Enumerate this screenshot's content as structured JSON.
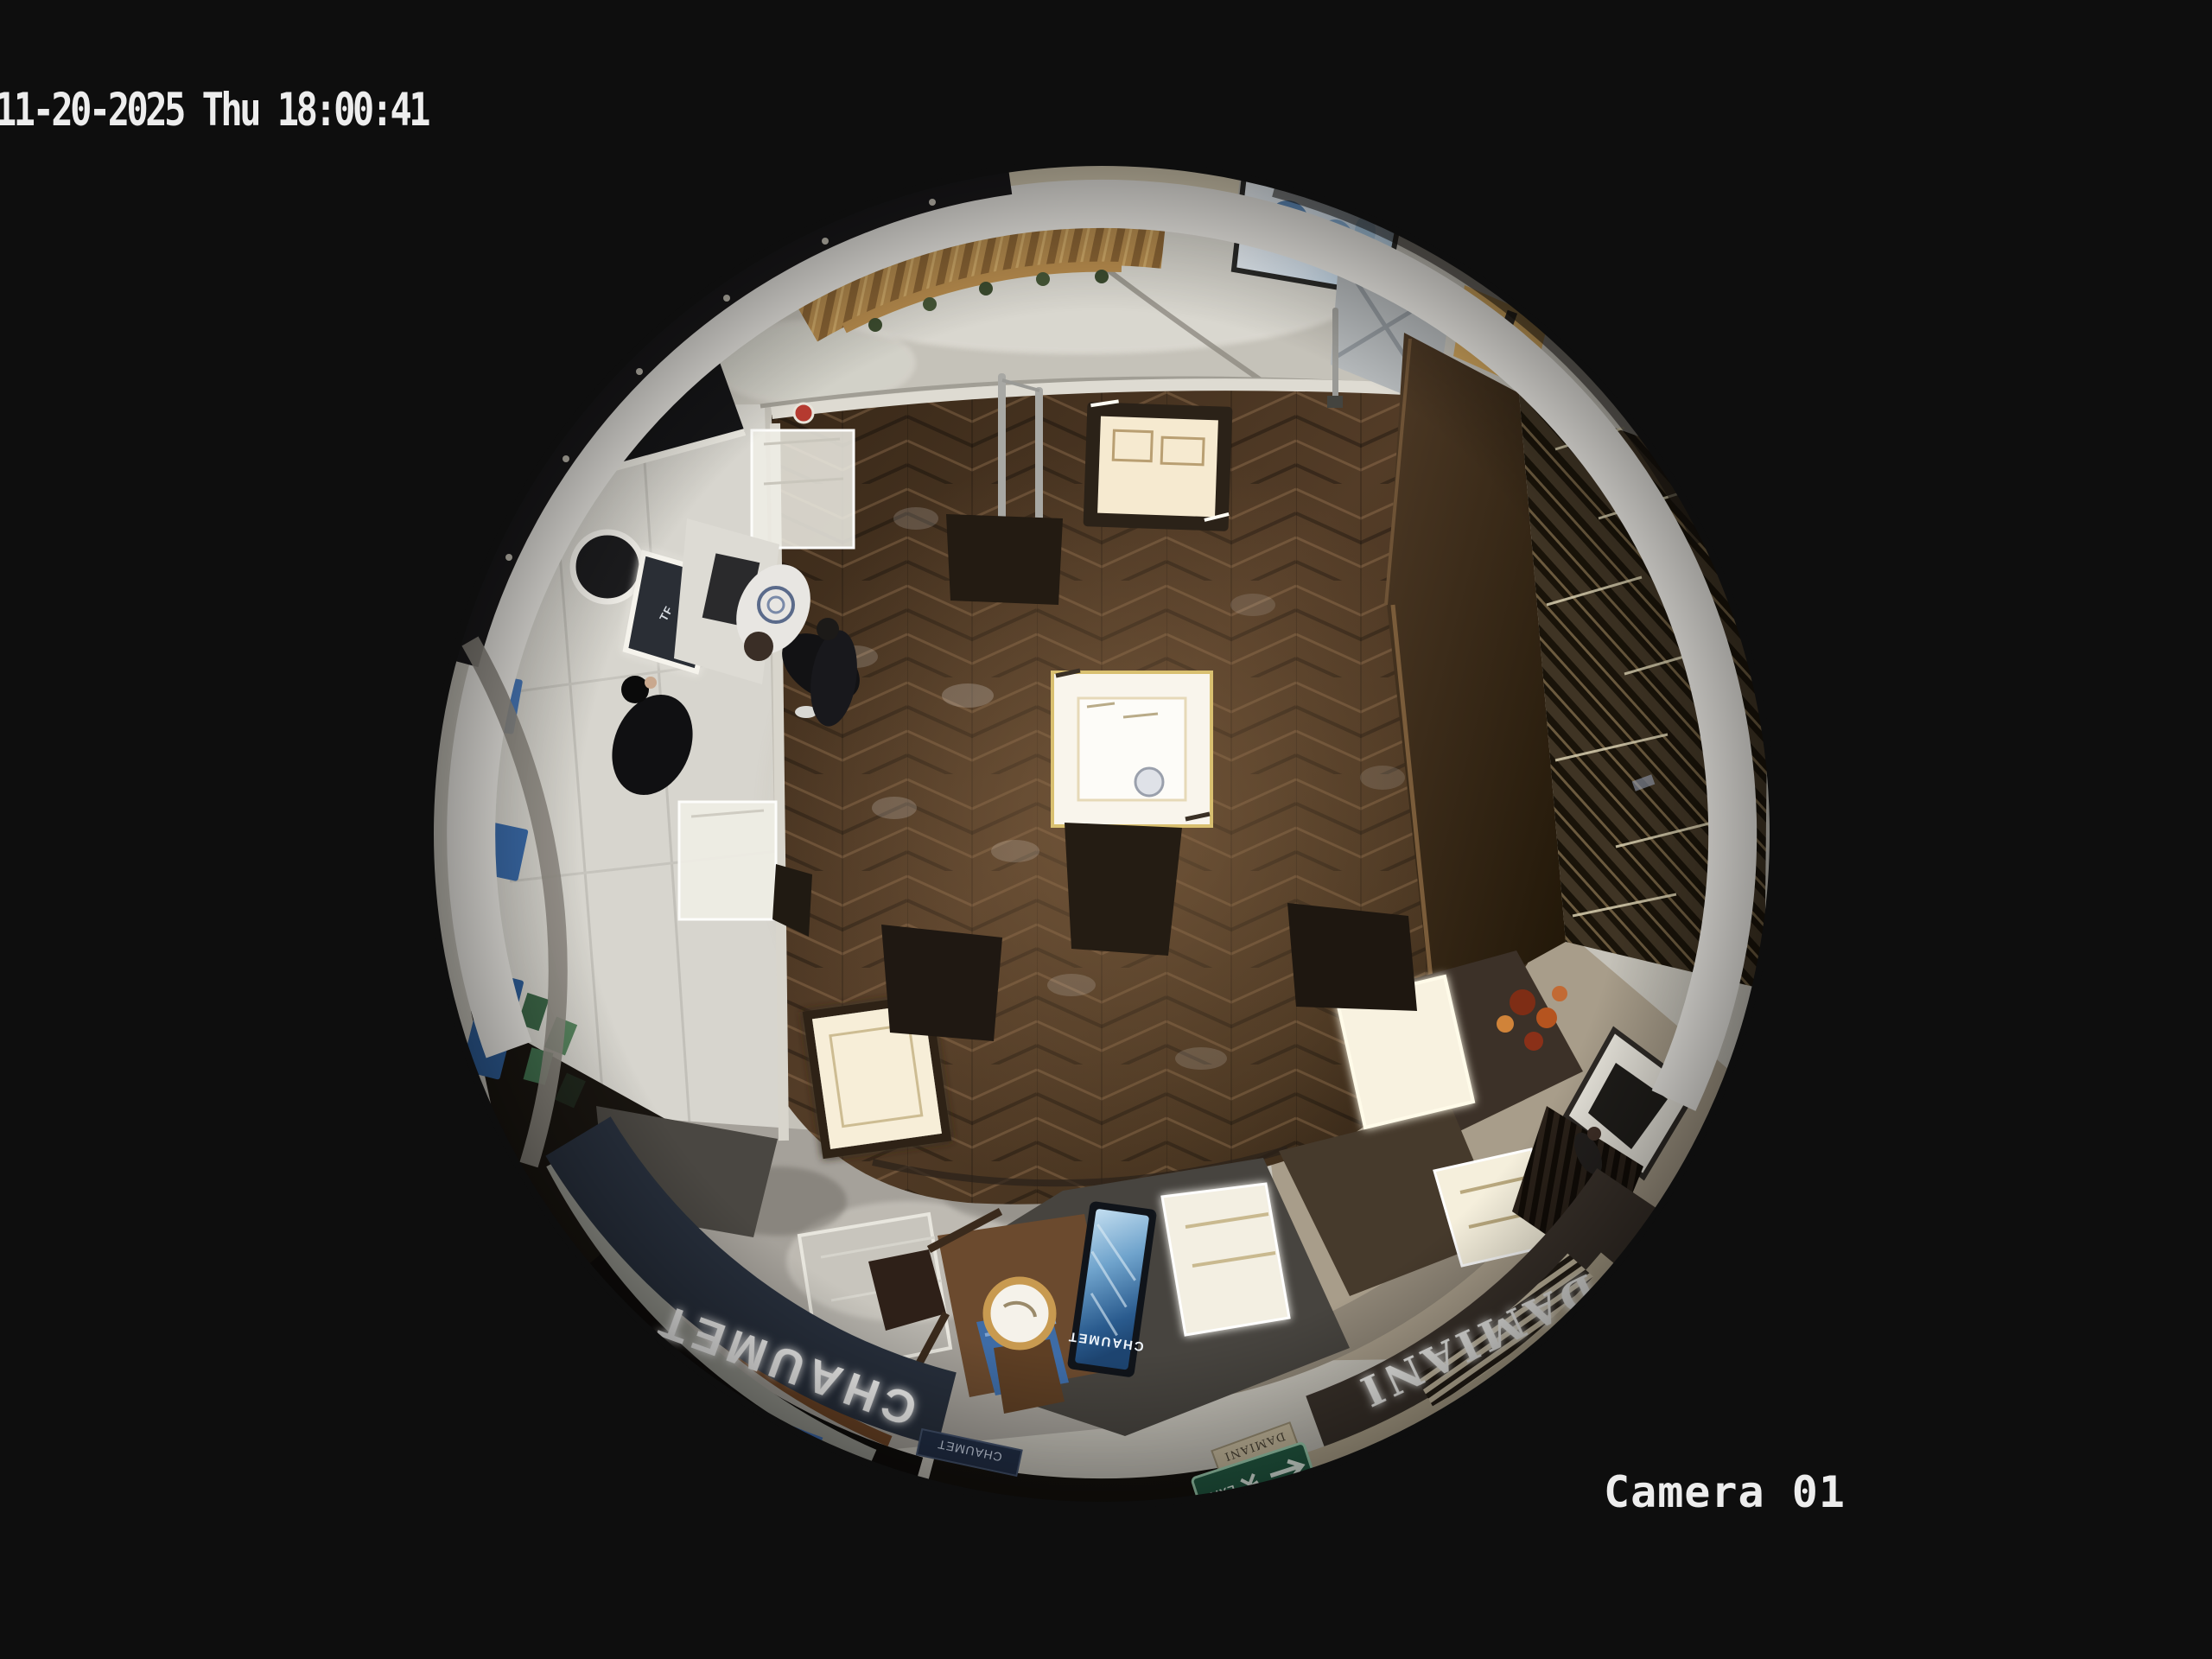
{
  "osd": {
    "datetime": "11-20-2025 Thu 18:00:41",
    "camera_label": "Camera 01",
    "text_color": "#ededed"
  },
  "signs": {
    "chaumet_fascia": "CHAUMET",
    "chaumet_plaque": "CHAUMET",
    "chaumet_screen": "CHAUMET",
    "damiani_fascia": "DAMIANI",
    "damiani_plaque": "DAMIANI",
    "tom_ford": "TOM FORD",
    "tf_panel": "TF",
    "tory_burch_fascia": "BURCH",
    "lamer_screen": "LAMER",
    "exit_sign": "EXIT"
  },
  "colors": {
    "background": "#0e0e0e",
    "osd_text": "#ededed",
    "chaumet_band": "#28303d",
    "damiani_band": "#3a322b",
    "wood_floor": "#3a2a1c",
    "marble_floor": "#cac7be",
    "screen_blue": "#2e5d97",
    "exit_green": "#235c44",
    "gold_text": "#8f7a46",
    "case_glow": "#f8f0da"
  }
}
